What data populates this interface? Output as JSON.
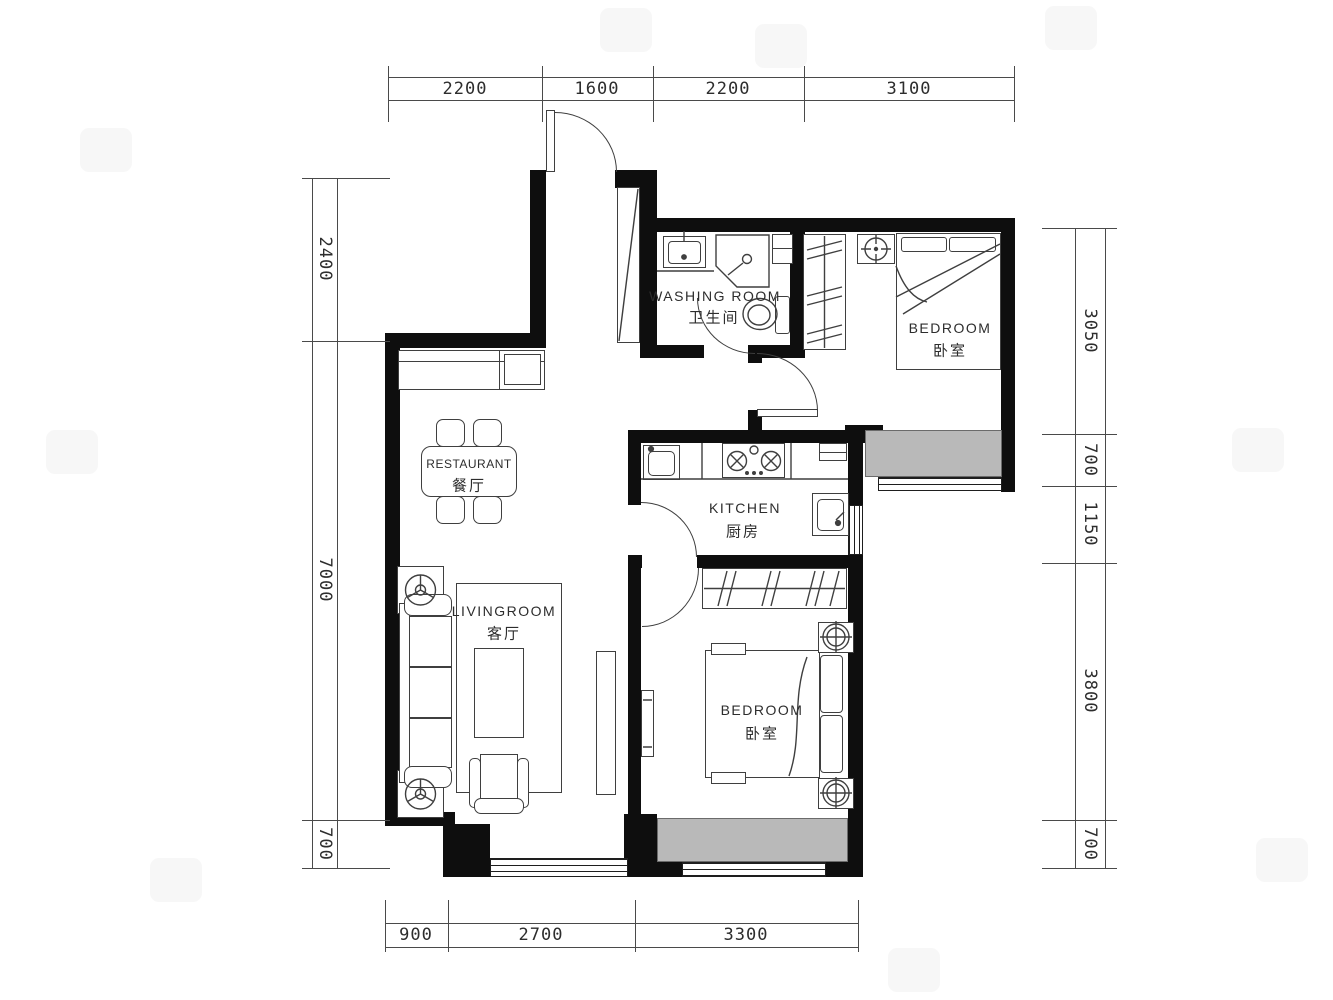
{
  "rooms": {
    "washing": {
      "en": "WASHING ROOM",
      "zh": "卫生间"
    },
    "bedroom1": {
      "en": "BEDROOM",
      "zh": "卧室"
    },
    "restaurant": {
      "en": "RESTAURANT",
      "zh": "餐厅"
    },
    "kitchen": {
      "en": "KITCHEN",
      "zh": "厨房"
    },
    "living": {
      "en": "LIVINGROOM",
      "zh": "客厅"
    },
    "bedroom2": {
      "en": "BEDROOM",
      "zh": "卧室"
    }
  },
  "dimensions": {
    "top": [
      "2200",
      "1600",
      "2200",
      "3100"
    ],
    "left": [
      "2400",
      "7000",
      "700"
    ],
    "right": [
      "3050",
      "700",
      "1150",
      "3800",
      "700"
    ],
    "bottom": [
      "900",
      "2700",
      "3300"
    ]
  },
  "colors": {
    "wall": "#0e0e0e",
    "bay_window_fill": "#b9b9b9",
    "line": "#3f3f3f"
  }
}
